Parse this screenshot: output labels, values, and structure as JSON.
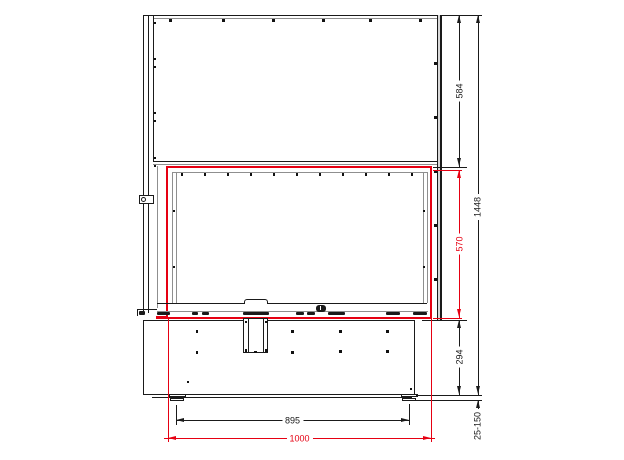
{
  "drawing": {
    "title": "fireplace-insert-front-elevation",
    "dimensions": {
      "top_section_height": "584",
      "glass_opening_height": "570",
      "base_height": "294",
      "total_height": "1448",
      "foot_adjust_range": "25-150",
      "foot_spacing": "895",
      "glass_opening_width": "1000"
    },
    "colors": {
      "line": "#1a1a1a",
      "secondary_line": "#8f8f8f",
      "highlight": "#e60012"
    }
  }
}
